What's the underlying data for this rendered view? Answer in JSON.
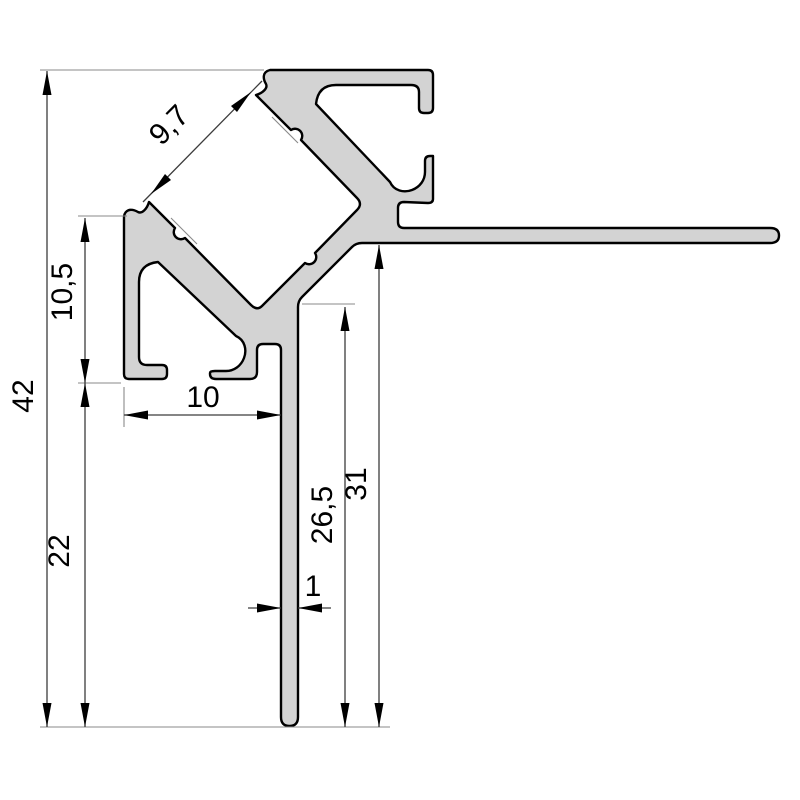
{
  "drawing": {
    "kind": "technical cross-section drawing",
    "subject": "aluminium corner profile with tile mounting flange and leg",
    "units": "mm",
    "colors": {
      "background": "#ffffff",
      "profile_fill": "#d3d3d3",
      "profile_outline": "#000000",
      "dimension_line": "#3c3c3c",
      "extension_line": "#8a8a8a",
      "text": "#000000"
    },
    "dimensions": {
      "overall_height": {
        "label": "42"
      },
      "lower_leg_span": {
        "label": "22"
      },
      "arm_depth": {
        "label": "10,5"
      },
      "foot_width": {
        "label": "10"
      },
      "wall_thickness": {
        "label": "1"
      },
      "leg_clear_height": {
        "label": "26,5"
      },
      "flange_underside_height": {
        "label": "31"
      },
      "channel_opening": {
        "label": "9,7"
      }
    }
  }
}
